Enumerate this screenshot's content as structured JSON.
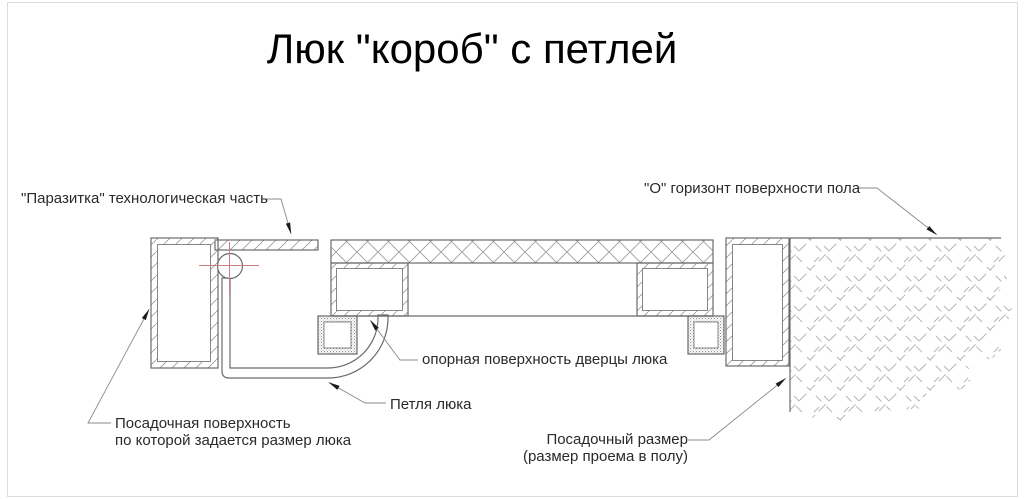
{
  "title": "Люк \"короб\" с петлей",
  "labels": {
    "parasitka": "\"Паразитка\" технологическая часть",
    "horizon": "\"О\" горизонт поверхности пола",
    "support_surface": "опорная поверхность дверцы люка",
    "hinge": "Петля люка",
    "seating_surface_line1": "Посадочная поверхность",
    "seating_surface_line2": "по которой задается размер люка",
    "seating_size_line1": "Посадочный размер",
    "seating_size_line2": "(размер проема в полу)"
  },
  "colors": {
    "line": "#6b6b6b",
    "thin": "#7a7a7a",
    "hatch": "#9e9e9e",
    "concrete": "#b5b5b5",
    "centerline": "#c98080",
    "leader": "#8a8a8a",
    "arrow": "#1a1a1a",
    "text": "#2a2a2a",
    "border": "#dcdcdc",
    "bg": "#ffffff"
  }
}
